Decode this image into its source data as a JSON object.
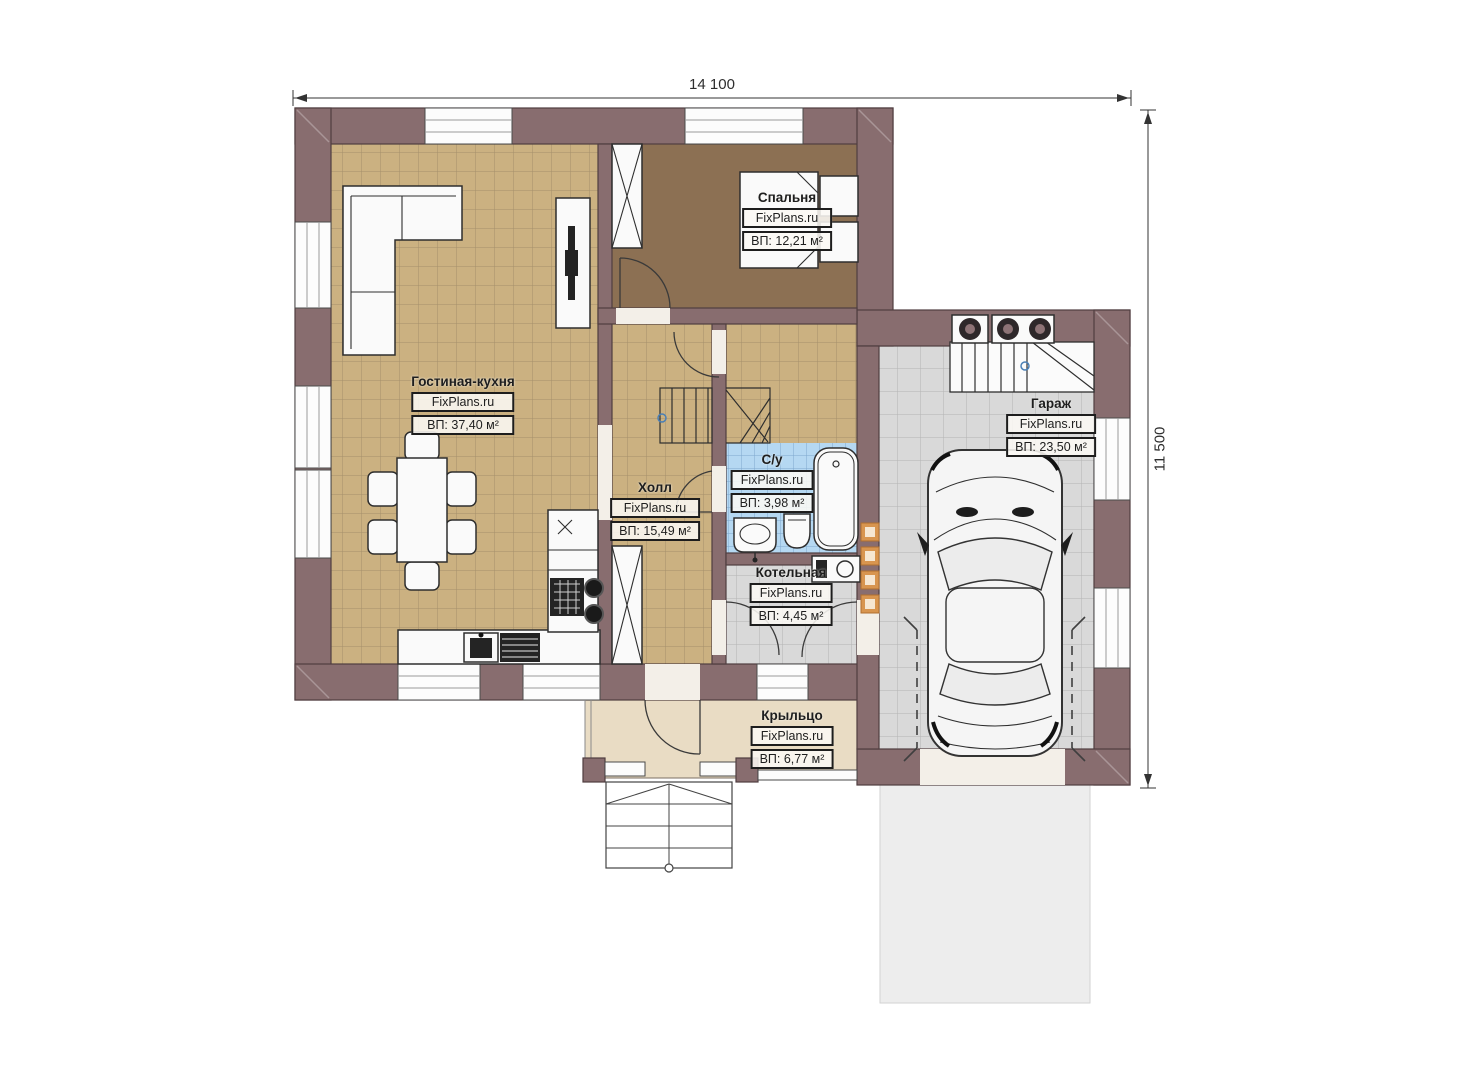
{
  "dimensions": {
    "width_label": "14 100",
    "height_label": "11 500"
  },
  "rooms": [
    {
      "id": "living-kitchen",
      "name": "Гостиная-кухня",
      "brand": "FixPlans.ru",
      "area": "ВП: 37,40 м²"
    },
    {
      "id": "bedroom",
      "name": "Спальня",
      "brand": "FixPlans.ru",
      "area": "ВП: 12,21 м²"
    },
    {
      "id": "hall",
      "name": "Холл",
      "brand": "FixPlans.ru",
      "area": "ВП: 15,49 м²"
    },
    {
      "id": "bathroom",
      "name": "С/у",
      "brand": "FixPlans.ru",
      "area": "ВП: 3,98 м²"
    },
    {
      "id": "boiler-room",
      "name": "Котельная",
      "brand": "FixPlans.ru",
      "area": "ВП: 4,45 м²"
    },
    {
      "id": "garage",
      "name": "Гараж",
      "brand": "FixPlans.ru",
      "area": "ВП: 23,50 м²"
    },
    {
      "id": "porch",
      "name": "Крыльцо",
      "brand": "FixPlans.ru",
      "area": "ВП: 6,77 м²"
    }
  ],
  "colors": {
    "wall": "#886d6f",
    "floor_tile_tan": "#cbb181",
    "floor_bedroom": "#8c7053",
    "floor_bath_blue": "#b5d8f2",
    "floor_gray": "#d9d9d9",
    "floor_porch": "#e9dcc4",
    "driveway": "#ededed",
    "ladder_orange": "#d8954f"
  }
}
